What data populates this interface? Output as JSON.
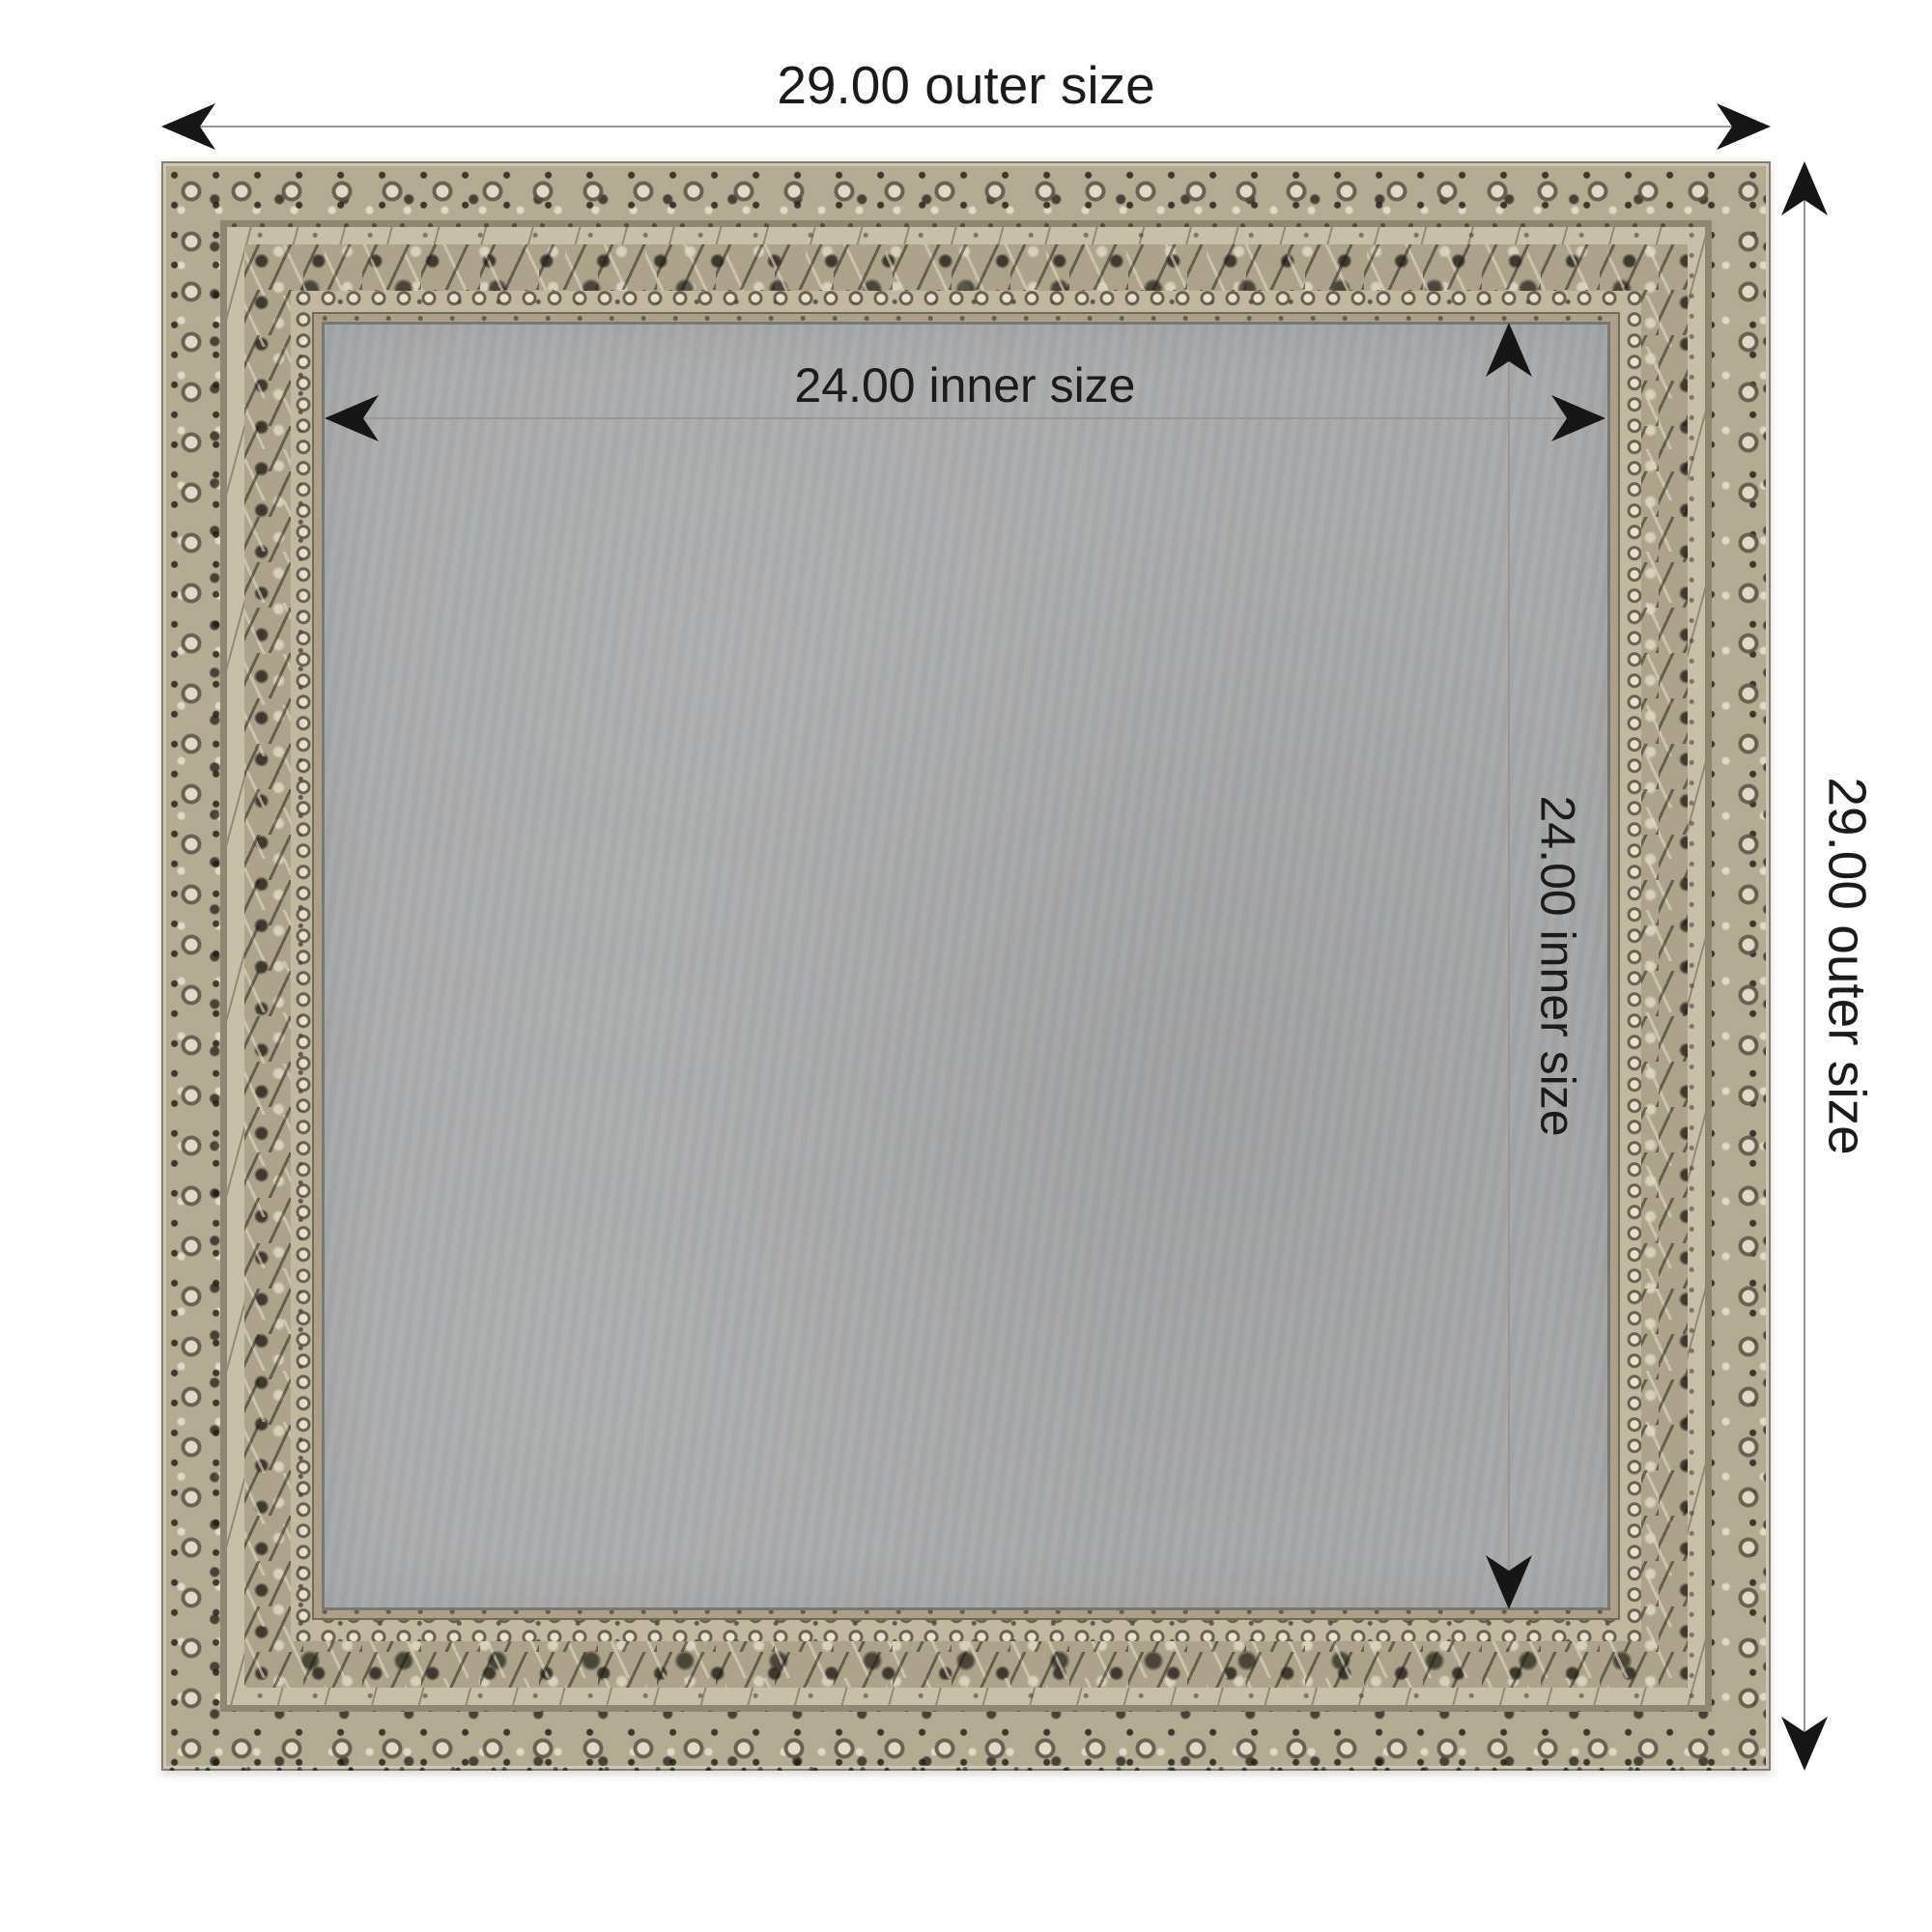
{
  "labels": {
    "outer_width": "29.00 outer size",
    "outer_height": "29.00 outer size",
    "inner_width": "24.00 inner size",
    "inner_height": "24.00 inner size"
  },
  "annotation": {
    "line_color": "#979797",
    "arrow_color": "#161616",
    "text_color": "#1b1b1b"
  },
  "frame": {
    "base_color": "#b4ab93",
    "highlight_color": "#d8d1bb",
    "distress_color": "#26241f",
    "groove_color": "#8f8771",
    "board_color": "#a9aaab"
  }
}
